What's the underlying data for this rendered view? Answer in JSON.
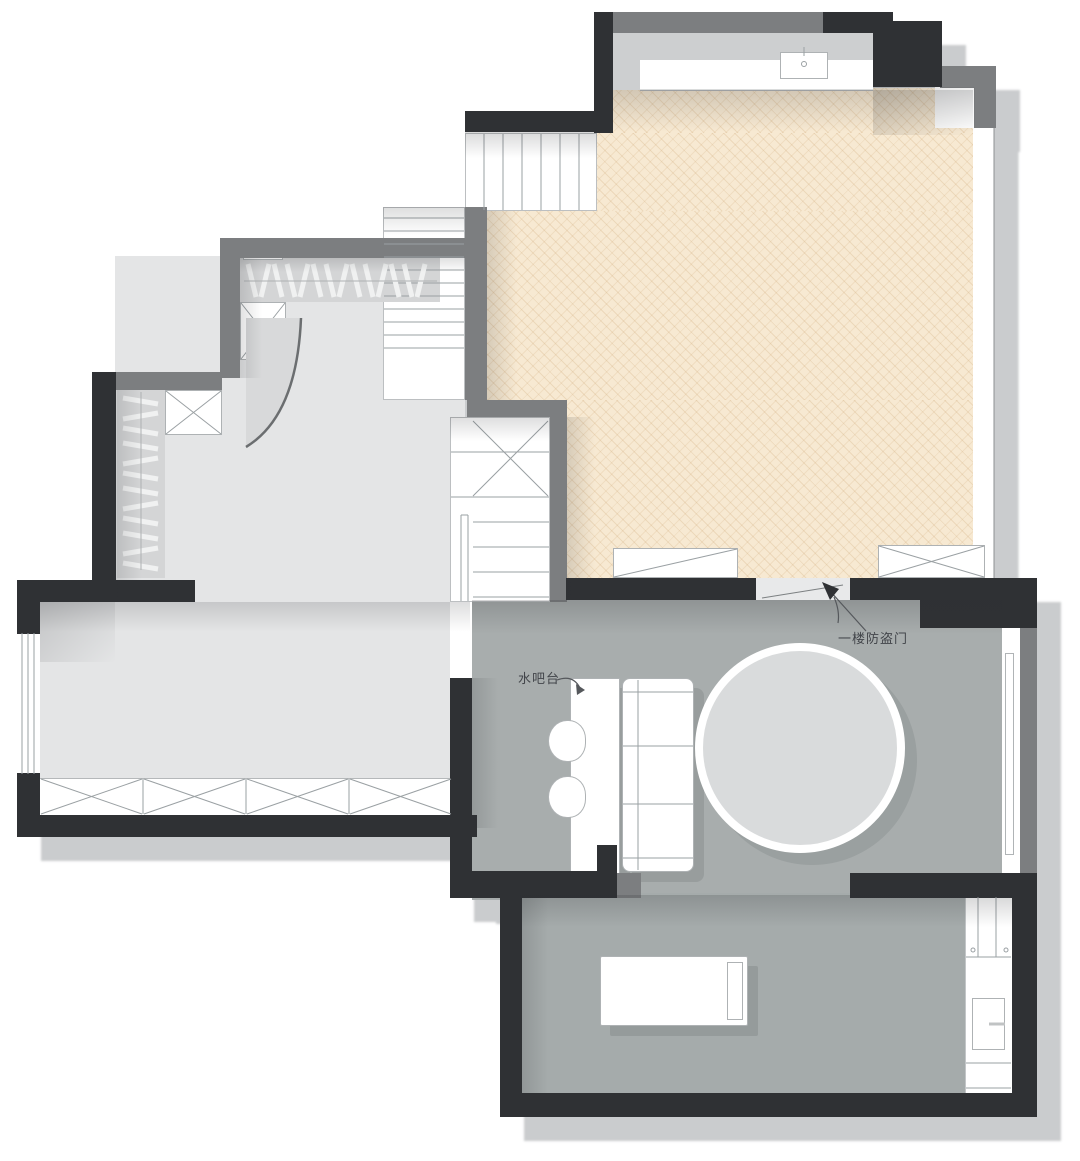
{
  "labels": {
    "water_bar": "水吧台",
    "security_door": "一楼防盗门"
  },
  "colors": {
    "wall_black": "#2f3134",
    "wall_gray": "#7c7e80",
    "floor_wood": "#f7e9d2",
    "floor_light": "#e4e5e6",
    "floor_gray": "#a8adad",
    "outer_shadow": "#caccce",
    "furniture_line": "#9aa0a3",
    "circle_fill": "#d9dbdc",
    "label_text": "#42454a"
  },
  "components": [
    "staircase-upper-flight",
    "staircase-long-flight",
    "staircase-lower-flight",
    "under-stair-storage",
    "wardrobe-hanging",
    "storage-x-cabinet",
    "curved-wall",
    "kitchen-counter",
    "sink",
    "bar-counter",
    "bar-stool",
    "sofa",
    "round-rug",
    "single-bed",
    "pillow",
    "utility-cabinet",
    "shower-tray",
    "window",
    "glass-wall",
    "security-door-arrow",
    "door-leaf"
  ]
}
